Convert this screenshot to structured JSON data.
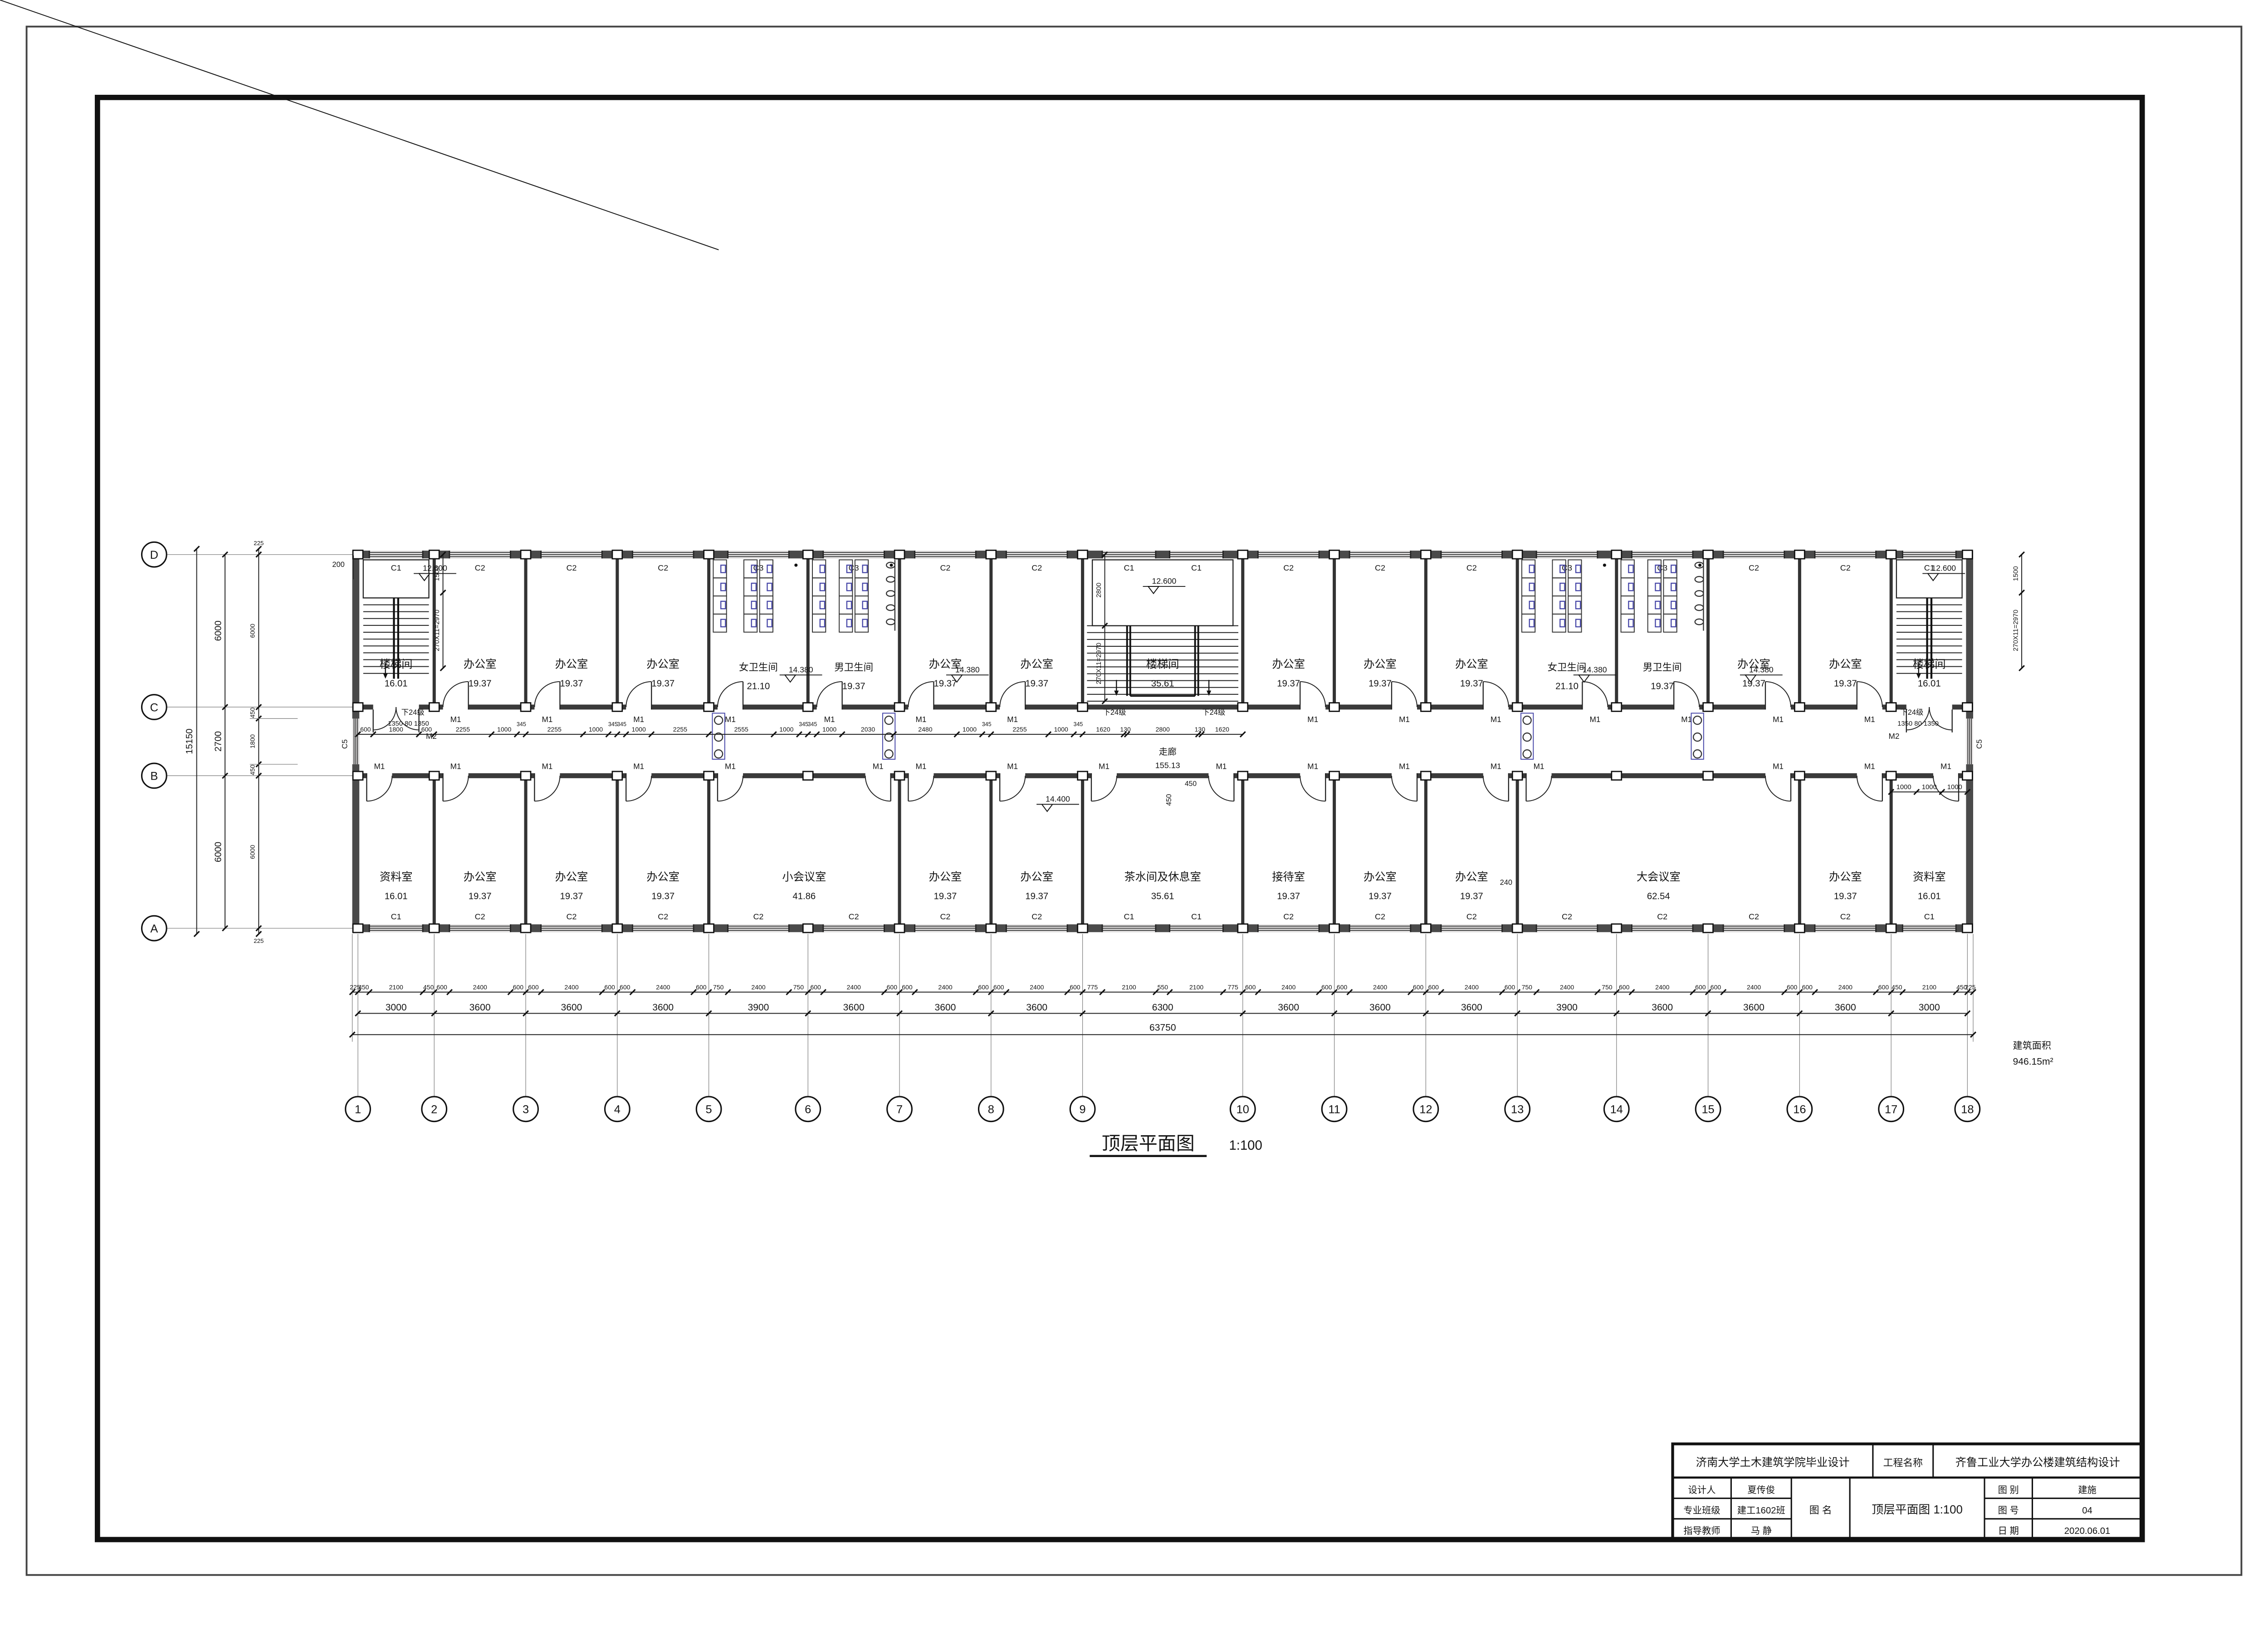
{
  "sheet": {
    "bg": "#ffffff",
    "line": "#141414",
    "wall": "#4a4a4a",
    "thin": "#333333",
    "accent_blue": "#4747a8"
  },
  "drawing_title": {
    "text": "顶层平面图",
    "scale": "1:100"
  },
  "area_note": {
    "label": "建筑面积",
    "value": "946.15m²"
  },
  "title_block": {
    "school": "济南大学土木建筑学院毕业设计",
    "project_label": "工程名称",
    "project_name": "齐鲁工业大学办公楼建筑结构设计",
    "designer_label": "设计人",
    "designer": "夏传俊",
    "class_label": "专业班级",
    "class_value": "建工1602班",
    "advisor_label": "指导教师",
    "advisor": "马  静",
    "name_label": "图  名",
    "drawing_name": "顶层平面图 1:100",
    "type_label": "图  别",
    "type_value": "建施",
    "no_label": "图  号",
    "no_value": "04",
    "date_label": "日  期",
    "date_value": "2020.06.01"
  },
  "grid": {
    "col_labels": [
      "1",
      "2",
      "3",
      "4",
      "5",
      "6",
      "7",
      "8",
      "9",
      "10",
      "11",
      "12",
      "13",
      "14",
      "15",
      "16",
      "17",
      "18"
    ],
    "row_labels": [
      "D",
      "C",
      "B",
      "A"
    ],
    "bays_mm": [
      3000,
      3600,
      3600,
      3600,
      3900,
      3600,
      3600,
      3600,
      6300,
      3600,
      3600,
      3600,
      3900,
      3600,
      3600,
      3600,
      3000
    ],
    "row_gaps_mm": [
      6000,
      2700,
      6000
    ],
    "edge_mm": 225
  },
  "corridor": {
    "name": "走廊",
    "area": "155.13"
  },
  "rooms_top": [
    {
      "name": "楼梯间",
      "area": "16.01",
      "from": 0,
      "to": 1,
      "kind": "stair_l"
    },
    {
      "name": "办公室",
      "area": "19.37",
      "from": 1,
      "to": 2,
      "kind": "office"
    },
    {
      "name": "办公室",
      "area": "19.37",
      "from": 2,
      "to": 3,
      "kind": "office"
    },
    {
      "name": "办公室",
      "area": "19.37",
      "from": 3,
      "to": 4,
      "kind": "office"
    },
    {
      "name": "女卫生间",
      "area": "21.10",
      "from": 4,
      "to": 5,
      "kind": "wc_w"
    },
    {
      "name": "男卫生间",
      "area": "19.37",
      "from": 5,
      "to": 6,
      "kind": "wc_m"
    },
    {
      "name": "办公室",
      "area": "19.37",
      "from": 6,
      "to": 7,
      "kind": "office"
    },
    {
      "name": "办公室",
      "area": "19.37",
      "from": 7,
      "to": 8,
      "kind": "office"
    },
    {
      "name": "楼梯间",
      "area": "35.61",
      "from": 8,
      "to": 9,
      "kind": "stair_c"
    },
    {
      "name": "办公室",
      "area": "19.37",
      "from": 9,
      "to": 10,
      "kind": "office"
    },
    {
      "name": "办公室",
      "area": "19.37",
      "from": 10,
      "to": 11,
      "kind": "office"
    },
    {
      "name": "办公室",
      "area": "19.37",
      "from": 11,
      "to": 12,
      "kind": "office"
    },
    {
      "name": "女卫生间",
      "area": "21.10",
      "from": 12,
      "to": 13,
      "kind": "wc_w"
    },
    {
      "name": "男卫生间",
      "area": "19.37",
      "from": 13,
      "to": 14,
      "kind": "wc_m"
    },
    {
      "name": "办公室",
      "area": "19.37",
      "from": 14,
      "to": 15,
      "kind": "office"
    },
    {
      "name": "办公室",
      "area": "19.37",
      "from": 15,
      "to": 16,
      "kind": "office"
    },
    {
      "name": "楼梯间",
      "area": "16.01",
      "from": 16,
      "to": 17,
      "kind": "stair_r"
    }
  ],
  "rooms_bottom": [
    {
      "name": "资料室",
      "area": "16.01",
      "from": 0,
      "to": 1
    },
    {
      "name": "办公室",
      "area": "19.37",
      "from": 1,
      "to": 2
    },
    {
      "name": "办公室",
      "area": "19.37",
      "from": 2,
      "to": 3
    },
    {
      "name": "办公室",
      "area": "19.37",
      "from": 3,
      "to": 4
    },
    {
      "name": "小会议室",
      "area": "41.86",
      "from": 4,
      "to": 6
    },
    {
      "name": "办公室",
      "area": "19.37",
      "from": 6,
      "to": 7
    },
    {
      "name": "办公室",
      "area": "19.37",
      "from": 7,
      "to": 8
    },
    {
      "name": "茶水间及休息室",
      "area": "35.61",
      "from": 8,
      "to": 9
    },
    {
      "name": "接待室",
      "area": "19.37",
      "from": 9,
      "to": 10
    },
    {
      "name": "办公室",
      "area": "19.37",
      "from": 10,
      "to": 11
    },
    {
      "name": "办公室",
      "area": "19.37",
      "from": 11,
      "to": 12
    },
    {
      "name": "大会议室",
      "area": "62.54",
      "from": 12,
      "to": 15
    },
    {
      "name": "办公室",
      "area": "19.37",
      "from": 15,
      "to": 16
    },
    {
      "name": "资料室",
      "area": "16.01",
      "from": 16,
      "to": 17
    }
  ],
  "windows_top": [
    "C1",
    "C2",
    "C2",
    "C2",
    "C3",
    "C3",
    "C2",
    "C2",
    [
      "C1",
      "C1"
    ],
    "C2",
    "C2",
    "C2",
    "C3",
    "C3",
    "C2",
    "C2",
    "C1"
  ],
  "windows_bottom": [
    "C1",
    "C2",
    "C2",
    "C2",
    "C2",
    "C2",
    "C2",
    "C2",
    [
      "C1",
      "C1"
    ],
    "C2",
    "C2",
    "C2",
    "C2",
    "C2",
    "C2",
    "C2",
    "C1"
  ],
  "side_window_label": "C5",
  "doors": {
    "office_label": "M1",
    "stair_label": "M2",
    "top": [
      [
        1,
        "L"
      ],
      [
        2,
        "L"
      ],
      [
        3,
        "L"
      ],
      [
        4,
        "L"
      ],
      [
        5,
        "L"
      ],
      [
        6,
        "L"
      ],
      [
        7,
        "L"
      ],
      [
        9,
        "R"
      ],
      [
        10,
        "R"
      ],
      [
        11,
        "R"
      ],
      [
        12,
        "R"
      ],
      [
        13,
        "R"
      ],
      [
        14,
        "R"
      ],
      [
        15,
        "R"
      ]
    ],
    "bottom": [
      [
        0,
        "L"
      ],
      [
        1,
        "L"
      ],
      [
        2,
        "L"
      ],
      [
        3,
        "L"
      ],
      [
        4,
        "L"
      ],
      [
        5,
        "R"
      ],
      [
        6,
        "L"
      ],
      [
        7,
        "L"
      ],
      [
        8,
        "L"
      ],
      [
        8,
        "R"
      ],
      [
        9,
        "R"
      ],
      [
        10,
        "R"
      ],
      [
        11,
        "R"
      ],
      [
        12,
        "L"
      ],
      [
        14,
        "R"
      ],
      [
        15,
        "R"
      ],
      [
        16,
        "R"
      ]
    ],
    "stair_bays": [
      0,
      16
    ]
  },
  "dims": {
    "bottom_fine": [
      "225",
      "450",
      "2100",
      "450",
      "600",
      "2400",
      "600",
      "600",
      "2400",
      "600",
      "600",
      "2400",
      "600",
      "750",
      "2400",
      "750",
      "600",
      "2400",
      "600",
      "600",
      "2400",
      "600",
      "600",
      "2400",
      "600",
      "775",
      "2100",
      "550",
      "2100",
      "775",
      "600",
      "2400",
      "600",
      "600",
      "2400",
      "600",
      "600",
      "2400",
      "600",
      "750",
      "2400",
      "750",
      "600",
      "2400",
      "600",
      "600",
      "2400",
      "600",
      "600",
      "2400",
      "600",
      "450",
      "2100",
      "450",
      "225"
    ],
    "bottom_bays": [
      "3000",
      "3600",
      "3600",
      "3600",
      "3900",
      "3600",
      "3600",
      "3600",
      "6300",
      "3600",
      "3600",
      "3600",
      "3900",
      "3600",
      "3600",
      "3600",
      "3000"
    ],
    "bottom_total": "63750",
    "left_fine": [
      "225",
      "6000",
      "450",
      "1800",
      "450",
      "6000",
      "225"
    ],
    "left_mid": [
      "6000",
      "2700",
      "6000"
    ],
    "left_total": "15150",
    "corridor_chain": [
      "600",
      "1800",
      "600",
      "2255",
      "1000",
      "345",
      "2255",
      "1000",
      "345",
      "345",
      "1000",
      "2255",
      "2555",
      "1000",
      "345",
      "345",
      "1000",
      "2030",
      "2480",
      "1000",
      "345",
      "2255",
      "1000",
      "345",
      "1620",
      "130",
      "2800",
      "130",
      "1620"
    ],
    "right_end_chain": [
      "1000",
      "1000",
      "1000"
    ],
    "stair_flight": "270X11=2970",
    "stair_landing_side": "1500",
    "stair_landing_center": "2800",
    "stair_width_note": "1350 80 1350",
    "down_steps": "下24级",
    "misc_200": "200",
    "misc_240": "240",
    "misc_450": "450"
  },
  "levels": {
    "roof": "12.600",
    "toilet_floor": "14.380",
    "floor": "14.400"
  }
}
